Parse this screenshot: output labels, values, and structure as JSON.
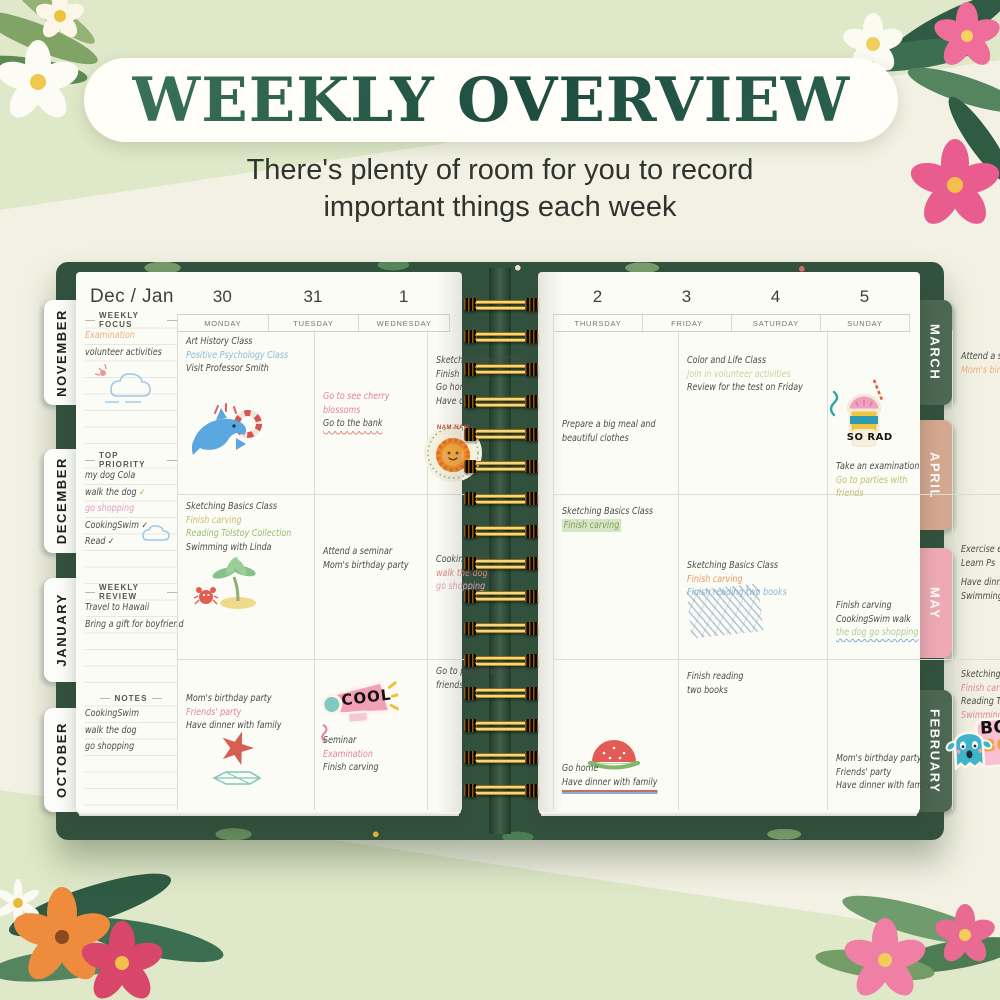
{
  "header": {
    "title": "WEEKLY OVERVIEW",
    "subtitle_line1": "There's plenty of room for you to record",
    "subtitle_line2": "important things each week"
  },
  "tabs": {
    "left": [
      "NOVEMBER",
      "DECEMBER",
      "JANUARY",
      "OCTOBER"
    ],
    "right": [
      "MARCH",
      "APRIL",
      "MAY",
      "FEBRUARY"
    ]
  },
  "left_page": {
    "month_label": "Dec / Jan",
    "dates": [
      "30",
      "31",
      "1"
    ],
    "days": [
      "MONDAY",
      "TUESDAY",
      "WEDNESDAY"
    ],
    "sidebar": {
      "sections": [
        {
          "title": "WEEKLY FOCUS",
          "lines": [
            {
              "t": "Examination",
              "c": "peach"
            },
            {
              "t": "volunteer activities",
              "c": "ink"
            }
          ]
        },
        {
          "title": "TOP PRIORITY",
          "lines": [
            {
              "t": "my dog Cola",
              "c": "ink"
            },
            {
              "t": "walk the dog",
              "c": "ink",
              "chk": "g"
            },
            {
              "t": "go shopping",
              "c": "pink"
            },
            {
              "t": "CookingSwim",
              "c": "ink",
              "chk": "k"
            },
            {
              "t": "Read",
              "c": "ink",
              "chk": "k"
            }
          ]
        },
        {
          "title": "WEEKLY REVIEW",
          "lines": [
            {
              "t": "Travel to Hawaii",
              "c": "ink"
            },
            {
              "t": "Bring a gift for boyfriend",
              "c": "ink"
            }
          ]
        },
        {
          "title": "NOTES",
          "lines": [
            {
              "t": "CookingSwim",
              "c": "ink"
            },
            {
              "t": "walk the dog",
              "c": "ink"
            },
            {
              "t": "go shopping",
              "c": "ink"
            }
          ]
        }
      ]
    },
    "cells": {
      "mon_1": {
        "lines": [
          {
            "t": "Art History Class",
            "c": "ink"
          },
          {
            "t": "Positive Psychology Class",
            "c": "blue"
          },
          {
            "t": "Visit Professor Smith",
            "c": "ink"
          }
        ]
      },
      "tue_1": {
        "lines": [
          {
            "t": "Go to see cherry",
            "c": "rose"
          },
          {
            "t": "blossoms",
            "c": "rose"
          },
          {
            "t": "Go to the bank",
            "c": "ink",
            "s": "u-scallop"
          }
        ]
      },
      "wed_1": {
        "lines": [
          {
            "t": "Sketching Basics Class",
            "c": "ink"
          },
          {
            "t": "Finish carving",
            "c": "ink"
          },
          {
            "t": "Go home",
            "c": "ink"
          },
          {
            "t": "Have dinner with family",
            "c": "ink"
          }
        ]
      },
      "mon_2": {
        "lines": [
          {
            "t": "Sketching Basics Class",
            "c": "ink"
          },
          {
            "t": "Finish carving",
            "c": "olive"
          },
          {
            "t": "Reading Tolstoy Collection",
            "c": "green"
          },
          {
            "t": "Swimming with Linda",
            "c": "ink"
          }
        ]
      },
      "tue_2": {
        "lines": [
          {
            "t": "Attend a seminar",
            "c": "ink"
          },
          {
            "t": "Mom's birthday party",
            "c": "ink"
          }
        ]
      },
      "wed_2": {
        "lines": [
          {
            "t": "CookingSwim",
            "c": "ink"
          },
          {
            "t": "walk the dog",
            "c": "red"
          },
          {
            "t": "go shopping",
            "c": "pink"
          }
        ]
      },
      "mon_3": {
        "lines": [
          {
            "t": "Mom's birthday party",
            "c": "ink"
          },
          {
            "t": "Friends' party",
            "c": "rose"
          },
          {
            "t": "Have dinner with family",
            "c": "ink"
          }
        ]
      },
      "tue_3": {
        "lines": [
          {
            "t": "Seminar",
            "c": "ink"
          },
          {
            "t": "Examination",
            "c": "rose"
          },
          {
            "t": "Finish carving",
            "c": "ink"
          }
        ]
      },
      "wed_3": {
        "lines": [
          {
            "t": "Go to parties with",
            "c": "ink"
          },
          {
            "t": "friends",
            "c": "ink"
          }
        ]
      }
    }
  },
  "right_page": {
    "dates": [
      "2",
      "3",
      "4",
      "5"
    ],
    "days": [
      "THURSDAY",
      "FRIDAY",
      "SATURDAY",
      "SUNDAY"
    ],
    "cells": {
      "thu_1": {
        "lines": [
          {
            "t": "Prepare a big meal and",
            "c": "ink"
          },
          {
            "t": "beautiful clothes",
            "c": "ink"
          }
        ]
      },
      "fri_1": {
        "lines": [
          {
            "t": "Color and Life Class",
            "c": "ink"
          },
          {
            "t": "Join in volunteer activities",
            "c": "lightolive"
          },
          {
            "t": "Review for the test on Friday",
            "c": "ink"
          }
        ]
      },
      "sat_1": {
        "lines": [
          {
            "t": "Take an examination",
            "c": "ink"
          },
          {
            "t": "Go to parties with",
            "c": "olive"
          },
          {
            "t": "friends",
            "c": "olive"
          }
        ]
      },
      "sun_1": {
        "lines": [
          {
            "t": "Attend a seminar",
            "c": "ink"
          },
          {
            "t": "Mom's birthday party",
            "c": "peach"
          }
        ]
      },
      "thu_2": {
        "lines": [
          {
            "t": "Sketching Basics Class",
            "c": "ink"
          },
          {
            "t": "Finish carving",
            "c": "hl-ink",
            "s": "hl-green"
          }
        ]
      },
      "fri_2": {
        "lines": [
          {
            "t": "Sketching Basics Class",
            "c": "ink"
          },
          {
            "t": "Finish carving",
            "c": "orange"
          },
          {
            "t": "Finish reading two books",
            "c": "blue"
          }
        ]
      },
      "sat_2": {
        "lines": [
          {
            "t": "Finish carving",
            "c": "ink"
          },
          {
            "t": "CookingSwim walk",
            "c": "ink"
          },
          {
            "t": "the dog go shopping",
            "c": "lightgreen",
            "s": "u-wavy"
          }
        ]
      },
      "sun_2": {
        "lines": [
          {
            "t": "Exercise every day",
            "c": "ink"
          },
          {
            "t": "Learn Ps",
            "c": "ink"
          },
          {
            "t": "Have dinner with family",
            "c": "ink",
            "s": "gap-top"
          },
          {
            "t": "Swimming with Linda",
            "c": "ink"
          }
        ]
      },
      "thu_3": {
        "lines": [
          {
            "t": "Go home",
            "c": "ink"
          },
          {
            "t": "Have dinner with family",
            "c": "ink",
            "s": "u-redblue"
          }
        ]
      },
      "fri_3": {
        "lines": [
          {
            "t": "Finish reading",
            "c": "ink"
          },
          {
            "t": "two books",
            "c": "ink"
          }
        ]
      },
      "sat_3": {
        "lines": [
          {
            "t": "Mom's birthday party",
            "c": "ink"
          },
          {
            "t": "Friends' party",
            "c": "ink"
          },
          {
            "t": "Have dinner with family",
            "c": "ink"
          }
        ]
      },
      "sun_3": {
        "lines": [
          {
            "t": "Sketching Basics Class",
            "c": "ink"
          },
          {
            "t": "Finish carving",
            "c": "rose"
          },
          {
            "t": "Reading Tolstoy Collection",
            "c": "ink"
          },
          {
            "t": "Swimming with Linda",
            "c": "rose"
          }
        ]
      }
    }
  },
  "stickers": {
    "nam_label": "NAM NAM",
    "cool_label": "COOL",
    "so_rad_label": "SO RAD",
    "booh_label": "BOOH!",
    "booh_echo": "BOOH!"
  },
  "palette": {
    "title_green": "#2a5a4a",
    "background_green": "#dfe8c8",
    "band_cream": "#f2f1e3",
    "cover_green": "#33523e",
    "tab_green": "#4c6752",
    "tab_tan": "#d4a78f",
    "tab_pink": "#efa9b4",
    "ink": "#4b4b48",
    "blue": "#8ab8d6",
    "rose": "#e2849b",
    "pink": "#dc9ec4",
    "red": "#d98880",
    "peach": "#efae78",
    "orange": "#e59a62",
    "olive": "#c3bd6e",
    "light_olive": "#cdd09c",
    "green": "#97ba70",
    "light_green": "#aecb95",
    "check_green": "#7cc04c",
    "spiral_gold": "#d9b34a"
  }
}
